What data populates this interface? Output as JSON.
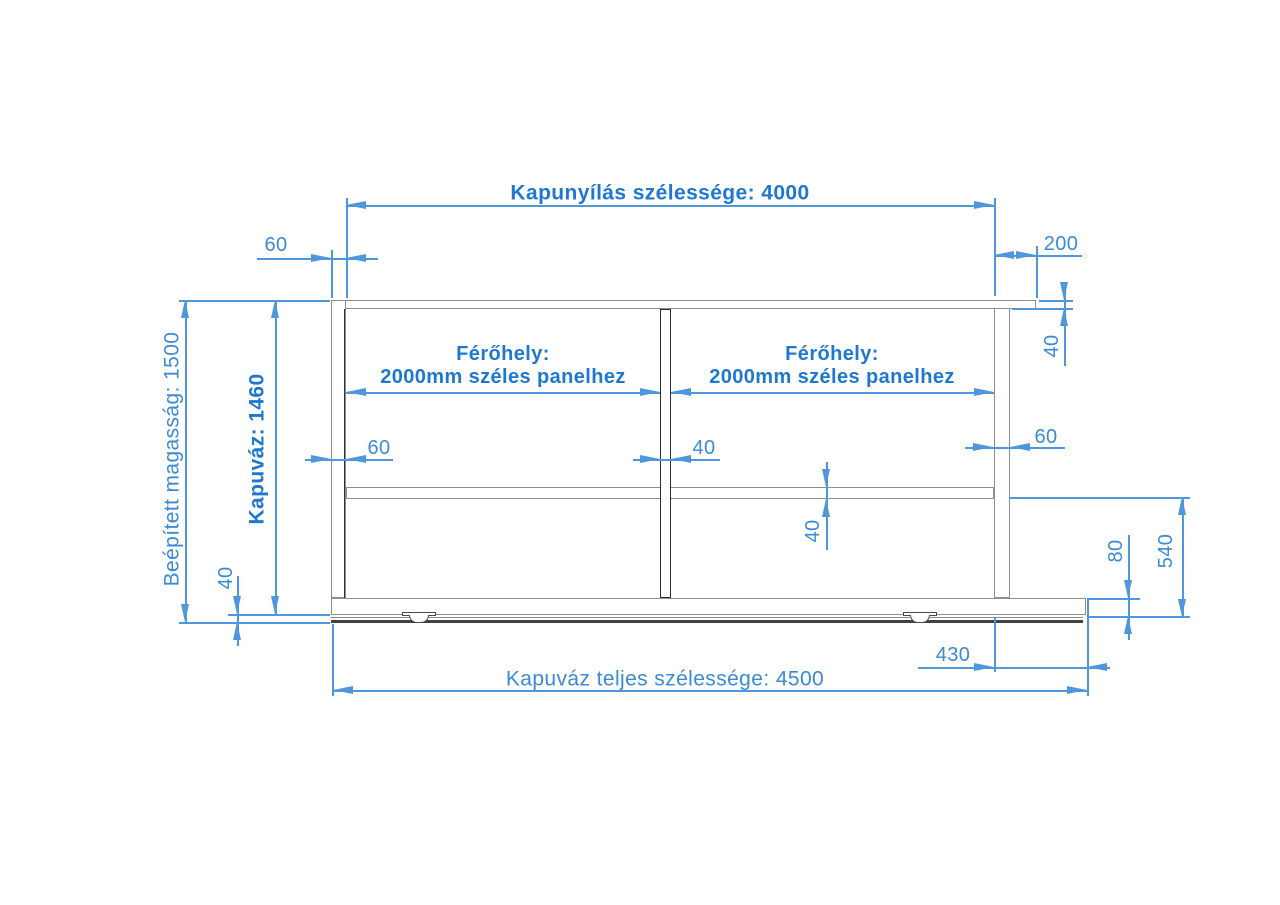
{
  "drawing": {
    "labels": {
      "opening_width": "Kapunyílás szélessége: 4000",
      "total_width": "Kapuváz teljes szélessége: 4500",
      "installed_height": "Beépített magasság: 1500",
      "frame_height": "Kapuváz: 1460"
    },
    "panel_space": {
      "line1": "Férőhely:",
      "line2": "2000mm széles panelhez"
    },
    "dims": {
      "left_post_width_top": "60",
      "top_tail_length": "200",
      "top_rail_height": "40",
      "left_post_width": "60",
      "mid_post_width": "40",
      "right_post_width": "60",
      "mid_rail_height": "40",
      "bottom_clearance": "40",
      "bottom_rail_height": "80",
      "lower_section_height": "540",
      "bottom_tail_length": "430"
    },
    "colors": {
      "dimension_blue": "#3b8ad8",
      "bold_blue": "#1e78d2",
      "profile_gray": "#8e8e8e",
      "dark_gray": "#303030"
    }
  }
}
